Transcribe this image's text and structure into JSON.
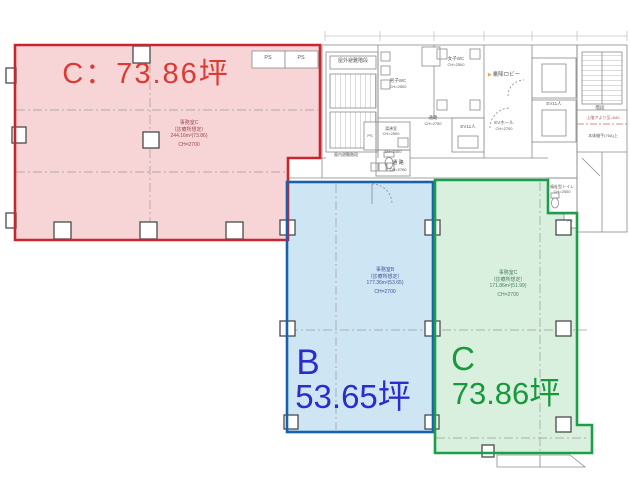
{
  "zones": {
    "red": {
      "big_label": "C：73.86坪",
      "room_name": "事務室C",
      "room_use": "（診療所想定）",
      "room_area": "244.16m²(73.86)",
      "room_ch": "CH=2700"
    },
    "blue": {
      "unit_letter": "B",
      "unit_area": "53.65坪",
      "room_name": "事務室B",
      "room_use": "（診療所想定）",
      "room_area": "177.36m²(53.65)",
      "room_ch": "CH=2700"
    },
    "green": {
      "unit_letter": "C",
      "unit_area": "73.86坪",
      "room_name": "事務室C",
      "room_use": "（診療所想定）",
      "room_area": "171.86m²(51.99)",
      "room_ch": "CH=2700"
    }
  },
  "core": {
    "outdoor_stair": "屋外避難階段",
    "indoor_stair": "屋内避難階段",
    "mens_wc": "男子WC",
    "mens_wc_ch": "CH=2500",
    "womens_wc": "女子WC",
    "womens_wc_ch": "CH=2500",
    "lobby": "乗降ロビー",
    "lobby_icon": "▶",
    "ev_hall": "EVホール",
    "ev_hall_ch": "CH=2700",
    "elevator": "EV11人",
    "corridor_upper": "通路",
    "corridor_upper_ch": "CH=2750",
    "kitchenette": "湯沸室",
    "kitchenette_ch": "CH=2500",
    "wc_small_ch": "CH=2400",
    "corridor_main": "通 路",
    "corridor_main_ch": "CH=2700",
    "accessible_wc": "福祉型トイレ",
    "accessible_wc_ch": "CH=2500",
    "shaft": "PS",
    "stair_label": "階段",
    "note_upper": "上階アより至=540",
    "note_lower": "本体継手(75A)上"
  },
  "colors": {
    "red_fill": "#f7d4d6",
    "red_border": "#c9252c",
    "red_text": "#dc3a33",
    "blue_fill": "#cee5f3",
    "blue_border": "#1761ae",
    "blue_text": "#2a2ccd",
    "green_fill": "#d9f0de",
    "green_border": "#1ba04a",
    "green_text": "#18993c"
  }
}
